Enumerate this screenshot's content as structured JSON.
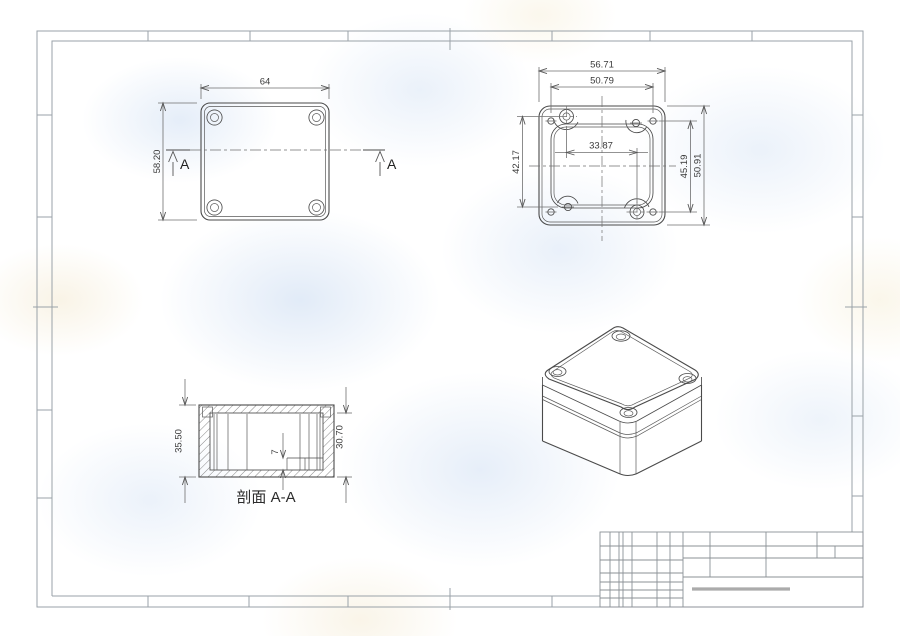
{
  "sheet": {
    "type": "engineering-drawing",
    "colors": {
      "part_line": "#4a4a4a",
      "dimension_line": "#6f6f6f",
      "frame_line": "#9aa2a8",
      "titleblock_line": "#8b9196",
      "watermark_blue": "#dce7f4",
      "watermark_warm": "#f4ecd9"
    }
  },
  "views": {
    "top_view": {
      "dim_width": "64",
      "dim_height": "58.20",
      "section_label": "A"
    },
    "back_view": {
      "dim_outer_width": "56.71",
      "dim_hole_span_width": "50.79",
      "dim_inner_span": "33.87",
      "dim_left_span": "42.17",
      "dim_right_inner_span": "45.19",
      "dim_right_outer_height": "50.91"
    },
    "section_view": {
      "caption": "剖面 A-A",
      "dim_overall_height": "35.50",
      "dim_base_height": "30.70",
      "dim_step_height": "7"
    }
  }
}
